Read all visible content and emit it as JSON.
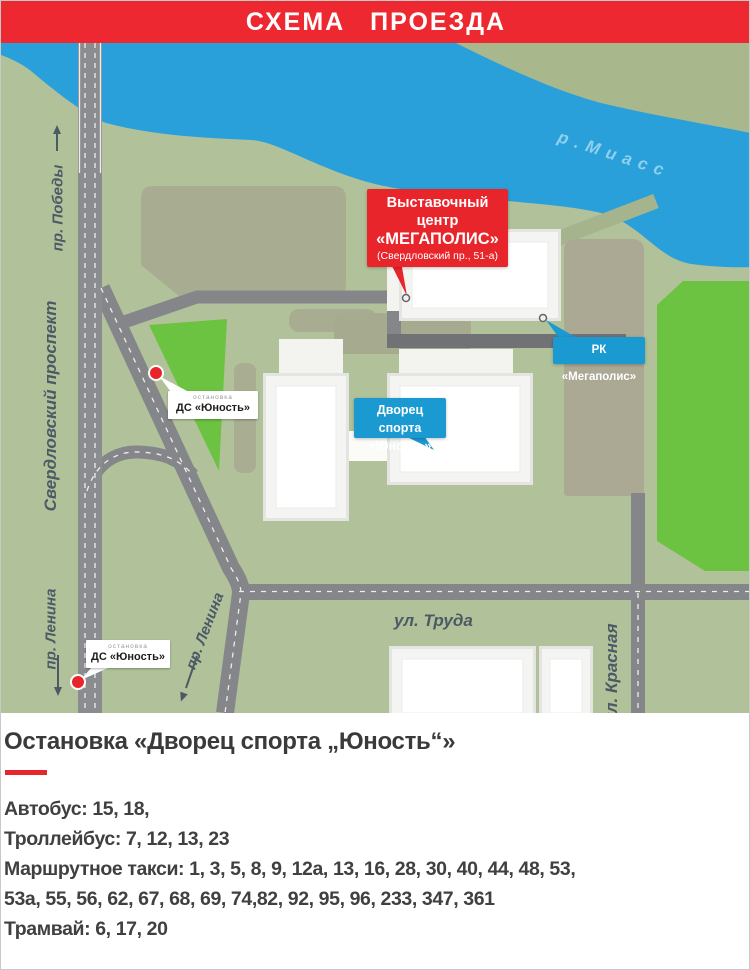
{
  "banner": {
    "title": "СХЕМА ПРОЕЗДА"
  },
  "map": {
    "river_label": "р.Миасс",
    "streets": {
      "pobedy": "пр. Победы",
      "sverdlovsky": "Свердловский проспект",
      "lenina_left": "пр. Ленина",
      "lenina_diagonal": "пр. Ленина",
      "truda": "ул. Труда",
      "krasnaya": "ул. Красная"
    },
    "expo_callout": {
      "line1": "Выставочный центр",
      "line2": "«МЕГАПОЛИС»",
      "line3": "(Свердловский пр., 51-а)"
    },
    "rk_callout": {
      "label": "РК «Мегаполис»"
    },
    "palace_callout": {
      "line1": "Дворец спорта",
      "line2": "«Юность»"
    },
    "stop_upper": {
      "caption": "остановка",
      "name": "ДС «Юность»"
    },
    "stop_lower": {
      "caption": "остановка",
      "name": "ДС «Юность»"
    }
  },
  "info": {
    "heading": "Остановка «Дворец спорта „Юность“»",
    "lines": [
      "Автобус: 15, 18,",
      "Троллейбус: 7, 12, 13, 23",
      "Маршрутное такси: 1, 3, 5, 8, 9, 12а, 13, 16, 28, 30, 40, 44, 48, 53,",
      "53а, 55, 56, 62, 67, 68, 69, 74,82, 92, 95, 96, 233, 347, 361",
      "Трамвай: 6, 17, 20"
    ]
  },
  "colors": {
    "accent_red": "#e8252b",
    "callout_blue": "#1b9ad2",
    "river_blue": "#2aa0da",
    "park_green": "#6cc241",
    "road_gray": "#85868a",
    "land_sage": "#b1c29b",
    "land_olive": "#a9b78d",
    "block_taupe": "#a8ad92"
  }
}
